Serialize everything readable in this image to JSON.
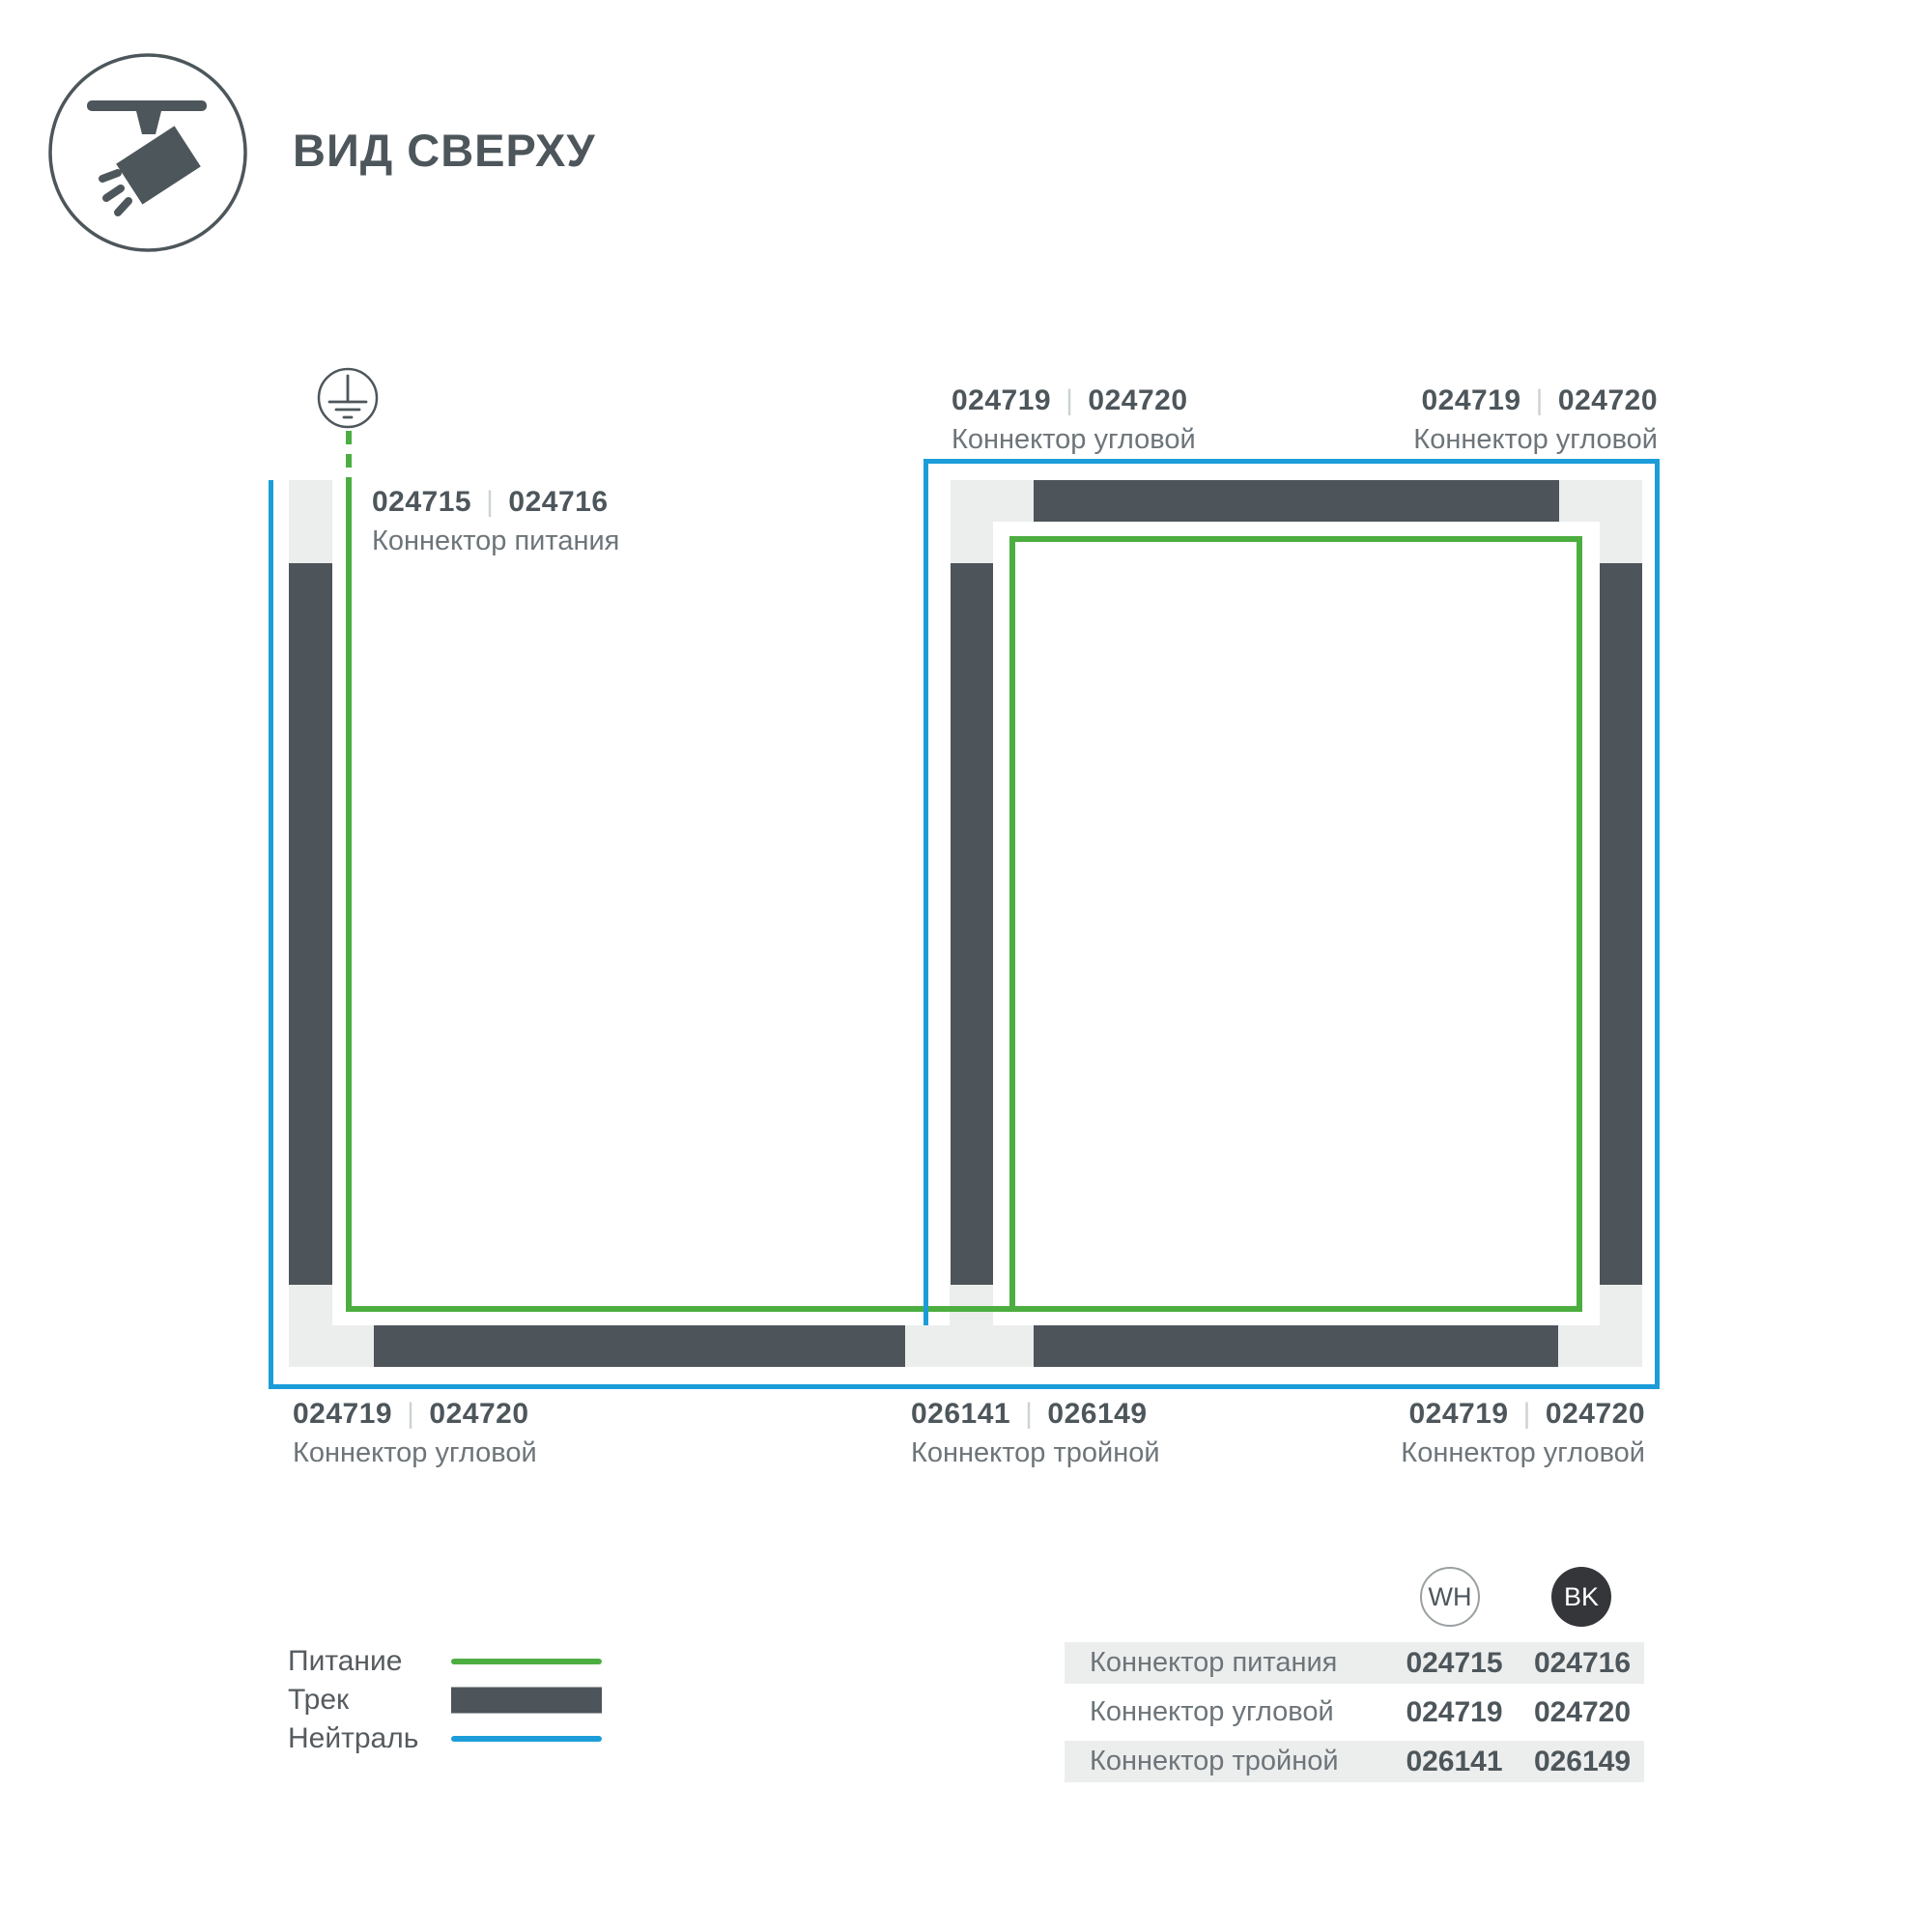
{
  "header": {
    "title": "ВИД СВЕРХУ",
    "icon": "track-spotlight-icon"
  },
  "colors": {
    "slate_text": "#4D565B",
    "track_dark": "#4D545A",
    "track_light": "#ECEEED",
    "power_green": "#4CAE40",
    "neutral_blue": "#1C9DD9",
    "label_gray": "#6D757A",
    "table_row_bg": "#ECEDED"
  },
  "diagram": {
    "ground_symbol": "ground-earth-icon",
    "labels": {
      "power": {
        "code_wh": "024715",
        "code_bk": "024716",
        "sep": "|",
        "name": "Коннектор питания"
      },
      "corner_top_left": {
        "code_wh": "024719",
        "code_bk": "024720",
        "sep": "|",
        "name": "Коннектор угловой"
      },
      "corner_top_right": {
        "code_wh": "024719",
        "code_bk": "024720",
        "sep": "|",
        "name": "Коннектор угловой"
      },
      "corner_bottom_left": {
        "code_wh": "024719",
        "code_bk": "024720",
        "sep": "|",
        "name": "Коннектор угловой"
      },
      "triple_bottom": {
        "code_wh": "026141",
        "code_bk": "026149",
        "sep": "|",
        "name": "Коннектор тройной"
      },
      "corner_bottom_right": {
        "code_wh": "024719",
        "code_bk": "024720",
        "sep": "|",
        "name": "Коннектор угловой"
      }
    }
  },
  "legend": {
    "items": [
      {
        "label": "Питание",
        "swatch": "power-line-green"
      },
      {
        "label": "Трек",
        "swatch": "track-bar-dark"
      },
      {
        "label": "Нейтраль",
        "swatch": "neutral-line-blue"
      }
    ]
  },
  "table": {
    "columns": [
      {
        "id": "WH"
      },
      {
        "id": "BK"
      }
    ],
    "rows": [
      {
        "name": "Коннектор питания",
        "wh": "024715",
        "bk": "024716"
      },
      {
        "name": "Коннектор угловой",
        "wh": "024719",
        "bk": "024720"
      },
      {
        "name": "Коннектор тройной",
        "wh": "026141",
        "bk": "026149"
      }
    ]
  }
}
